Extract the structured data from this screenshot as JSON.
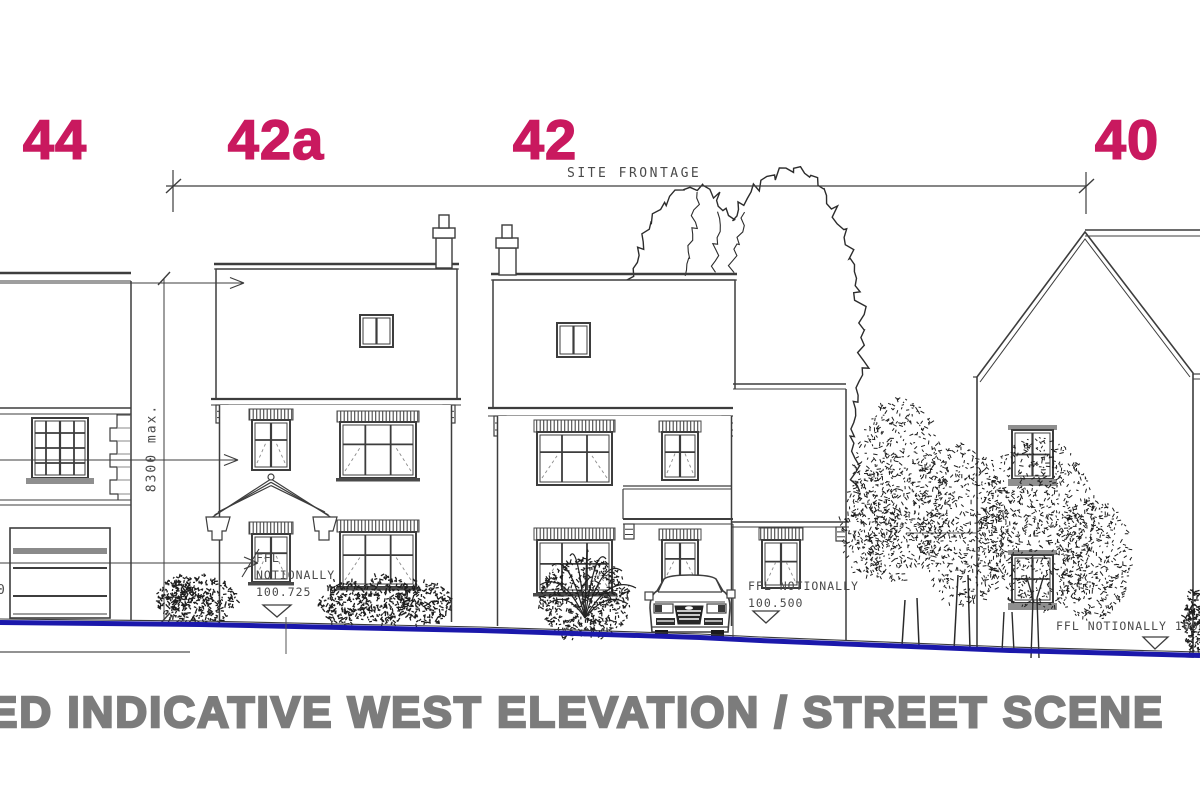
{
  "drawing_title": {
    "text": "ED INDICATIVE WEST ELEVATION / STREET SCENE"
  },
  "house_numbers": {
    "items": [
      {
        "id": "44",
        "label": "44"
      },
      {
        "id": "42a",
        "label": "42a"
      },
      {
        "id": "42",
        "label": "42"
      },
      {
        "id": "40",
        "label": "40"
      }
    ]
  },
  "dimensions": {
    "site_frontage": "SITE FRONTAGE",
    "max_height": "8300 max."
  },
  "levels": {
    "house_42a": {
      "line1": "FFL",
      "line2": "NOTIONALLY",
      "value": "100.725"
    },
    "house_42": {
      "line1": "FFL NOTIONALLY",
      "value": "100.500"
    },
    "house_40": {
      "line1": "FFL NOTIONALLY 100.000"
    }
  },
  "fragments": {
    "left_edge": "0"
  },
  "colors": {
    "house_number": "#c9195f",
    "title_gray": "#7c7c7c",
    "ground_line_blue": "#1b18ab",
    "line_dark": "#3d3d3d"
  }
}
